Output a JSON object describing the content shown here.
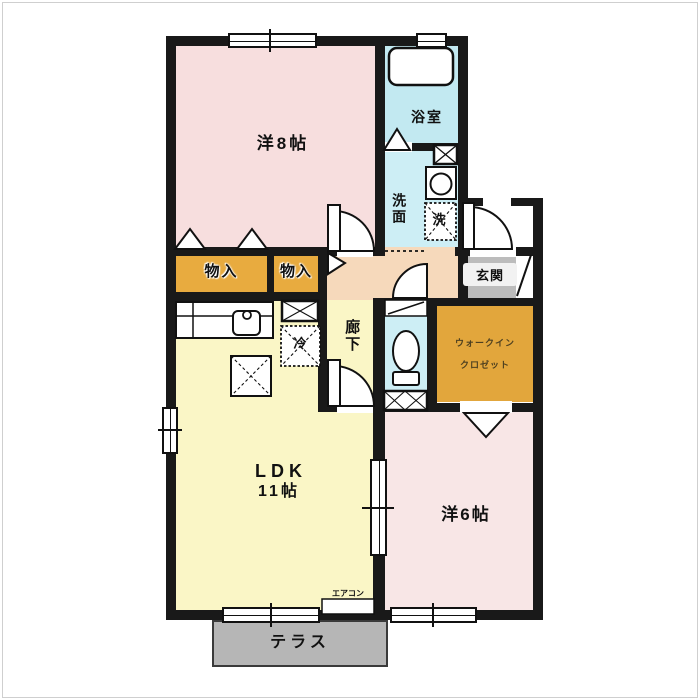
{
  "floorplan": {
    "rooms": {
      "western8": "洋8帖",
      "bathroom": "浴室",
      "washroom": "洗面",
      "laundry": "洗",
      "storage1": "物入",
      "storage2": "物入",
      "hallway": "廊下",
      "entrance": "玄関",
      "walkin_line1": "ウォークイン",
      "walkin_line2": "クロゼット",
      "ldk_line1": "LDK",
      "ldk_line2": "11帖",
      "western6": "洋6帖",
      "terrace": "テラス",
      "fridge": "冷",
      "aircon": "エアコン"
    },
    "colors": {
      "wall": "#191919",
      "western_room": "#f7dede",
      "western_room2": "#f8e6e6",
      "bathroom": "#c2e9f1",
      "wet_room": "#cdeef5",
      "storage": "#e8ab3f",
      "walkin_closet": "#e2a63c",
      "hallway": "#f6d9bb",
      "ldk": "#faf6c6",
      "entrance": "#bcbcbc",
      "terrace": "#b6b6b6"
    }
  }
}
